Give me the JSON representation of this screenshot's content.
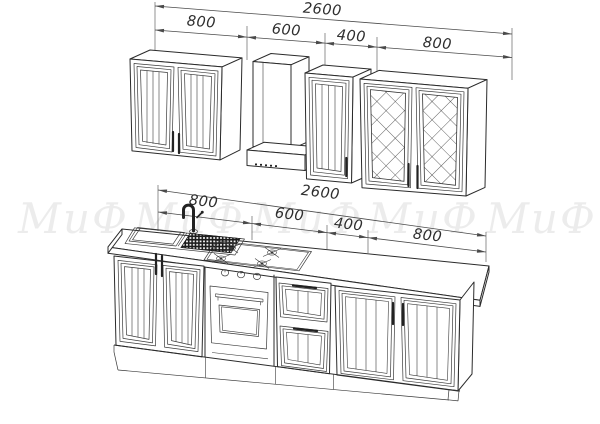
{
  "drawing": {
    "subject": "kitchen-set-technical-drawing",
    "units": "mm"
  },
  "dimensions": {
    "top": {
      "total": "2600",
      "segments": [
        "800",
        "600",
        "400",
        "800"
      ]
    },
    "middle": {
      "total": "2600",
      "segments": [
        "800",
        "600",
        "400",
        "800"
      ]
    }
  },
  "watermark": {
    "text": "МиФ",
    "repeat": 5
  },
  "colors": {
    "background": "#ffffff",
    "line": "#2b2b2b",
    "dimension": "#4a4a4a",
    "watermark": "rgba(0,0,0,0.075)"
  }
}
